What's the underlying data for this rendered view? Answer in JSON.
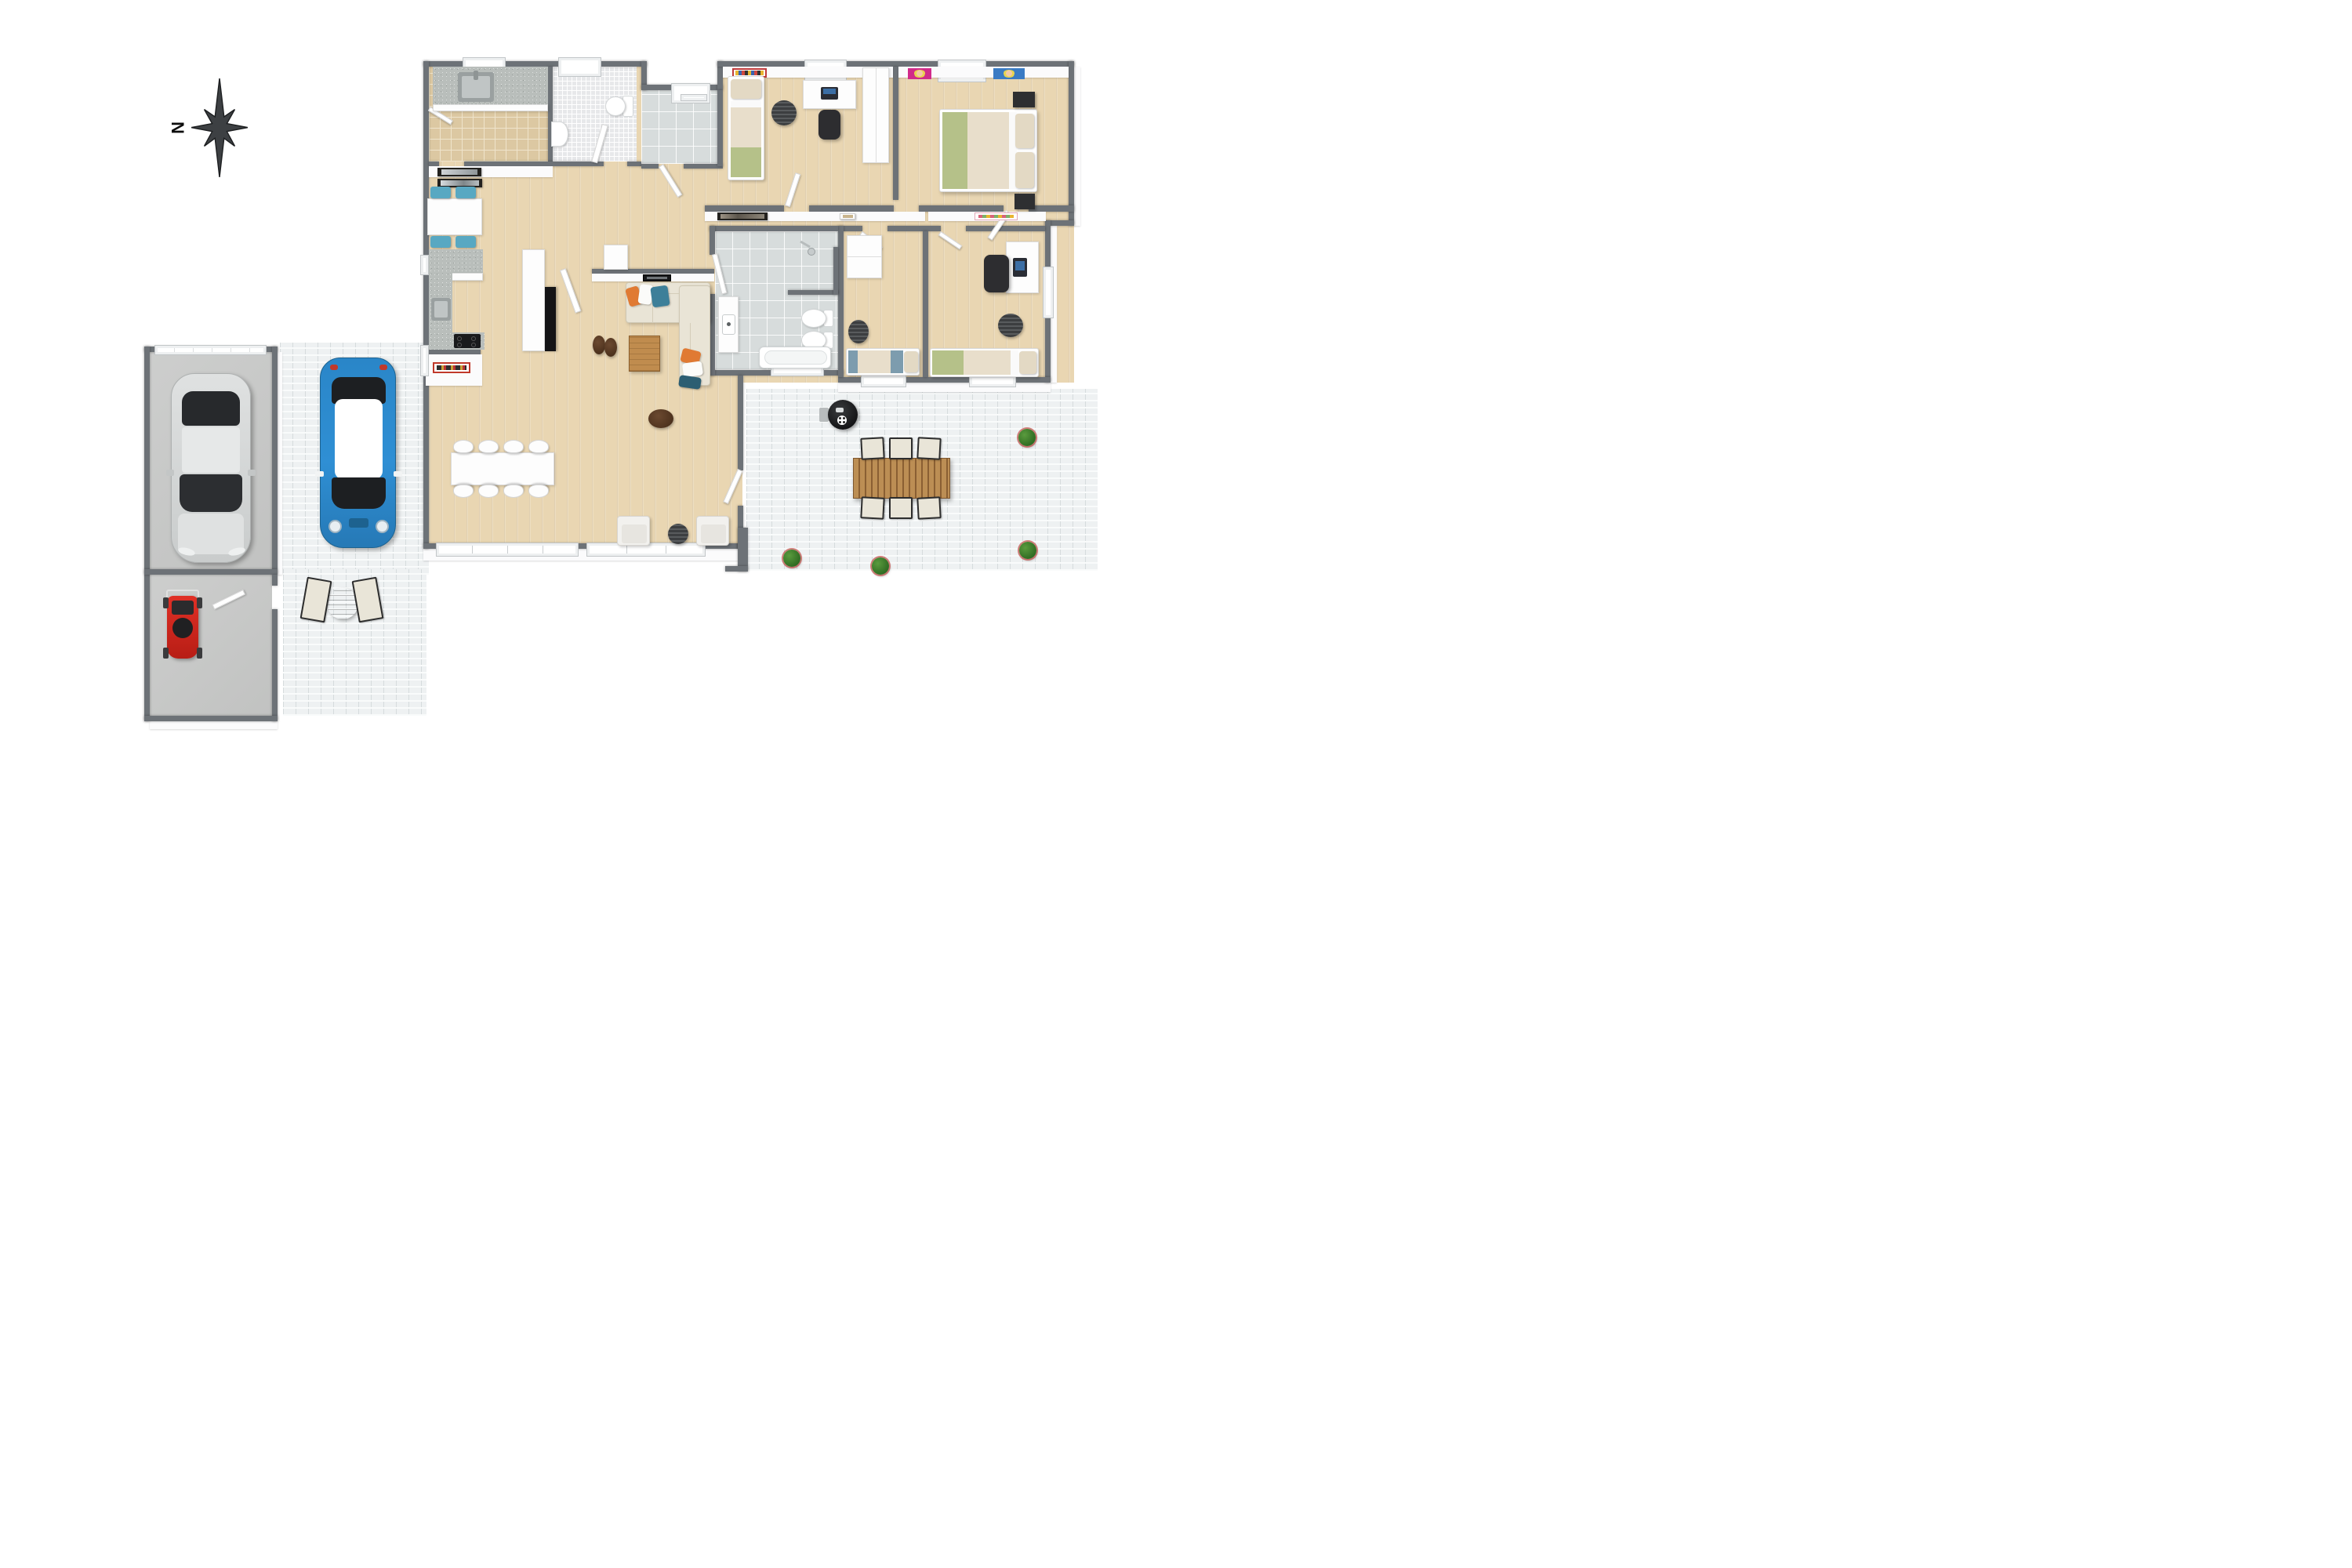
{
  "title": "3D floor plan rendering, top-down view",
  "compass": {
    "label": "N",
    "orientation": "north-points-left"
  },
  "palette": {
    "wall_gray": "#6d7277",
    "wood_floor": "#e9d6b2",
    "beige_tile": "#dcc8a2",
    "mosaic_tile": "#e7e8ea",
    "gray_tile": "#d7dcdc",
    "paver_white": "#eef1f2",
    "concrete": "#c9cac9",
    "sofa_beige": "#e9e4d6",
    "accent_orange": "#e07a33",
    "accent_teal": "#3d7f99",
    "blue_car": "#2f8fd4",
    "red_mower": "#d42420",
    "chair_blue": "#58a8c2",
    "bed_green": "#b5c189",
    "plant_green": "#3f7d2c"
  },
  "rooms": [
    {
      "name": "utility-room",
      "floor": "beige-tile",
      "items": [
        "counter with sink",
        "cabinets",
        "window",
        "door"
      ]
    },
    {
      "name": "bathroom-top",
      "floor": "white-mosaic",
      "items": [
        "toilet",
        "pedestal sink",
        "window",
        "door"
      ]
    },
    {
      "name": "mudroom",
      "floor": "gray-tile",
      "items": [
        "window",
        "entry door"
      ]
    },
    {
      "name": "kids-bedroom",
      "floor": "wood",
      "items": [
        "single bed",
        "poster",
        "window",
        "desk with laptop",
        "office chair",
        "stool",
        "wardrobe"
      ]
    },
    {
      "name": "master-bedroom",
      "floor": "wood",
      "items": [
        "double bed",
        "two nightstands",
        "two pop-art posters",
        "window"
      ]
    },
    {
      "name": "hallway",
      "floor": "wood",
      "items": [
        "two framed artworks",
        "doors"
      ]
    },
    {
      "name": "kitchen",
      "floor": "wood",
      "items": [
        "breakfast table",
        "4 blue chairs",
        "wall art",
        "L-shaped counter",
        "sink",
        "cooktop",
        "red framed poster",
        "tall cabinet",
        "fireplace"
      ]
    },
    {
      "name": "dining-area",
      "floor": "wood",
      "items": [
        "white table",
        "8 white chairs"
      ]
    },
    {
      "name": "living-room",
      "floor": "wood",
      "items": [
        "L-shaped sofa",
        "throw pillows",
        "coffee table",
        "two poufs",
        "floor pouf",
        "TV",
        "sideboard",
        "two armchairs",
        "round side table"
      ]
    },
    {
      "name": "main-bathroom",
      "floor": "gray-tile",
      "items": [
        "shower",
        "vanity sink",
        "two toilets",
        "bathtub",
        "window"
      ]
    },
    {
      "name": "bedroom-blue",
      "floor": "wood",
      "items": [
        "single bed blue accent",
        "round rug",
        "wardrobe",
        "window"
      ]
    },
    {
      "name": "bedroom-office",
      "floor": "wood",
      "items": [
        "single bed green accent",
        "round rug",
        "desk with laptop",
        "office chair",
        "poster",
        "windows"
      ]
    },
    {
      "name": "garage",
      "floor": "concrete",
      "items": [
        "silver car",
        "segmented garage door"
      ]
    },
    {
      "name": "shed",
      "floor": "concrete",
      "items": [
        "red lawn mower",
        "door"
      ]
    },
    {
      "name": "driveway",
      "floor": "white-pavers",
      "items": [
        "blue mini car with white roof"
      ]
    },
    {
      "name": "front-patio",
      "floor": "white-pavers",
      "items": [
        "round wooden table",
        "two white lounge chairs"
      ]
    },
    {
      "name": "back-patio",
      "floor": "white-pavers",
      "items": [
        "kettle grill",
        "slatted wood dining table",
        "6 outdoor chairs",
        "4 potted shrubs"
      ]
    }
  ]
}
